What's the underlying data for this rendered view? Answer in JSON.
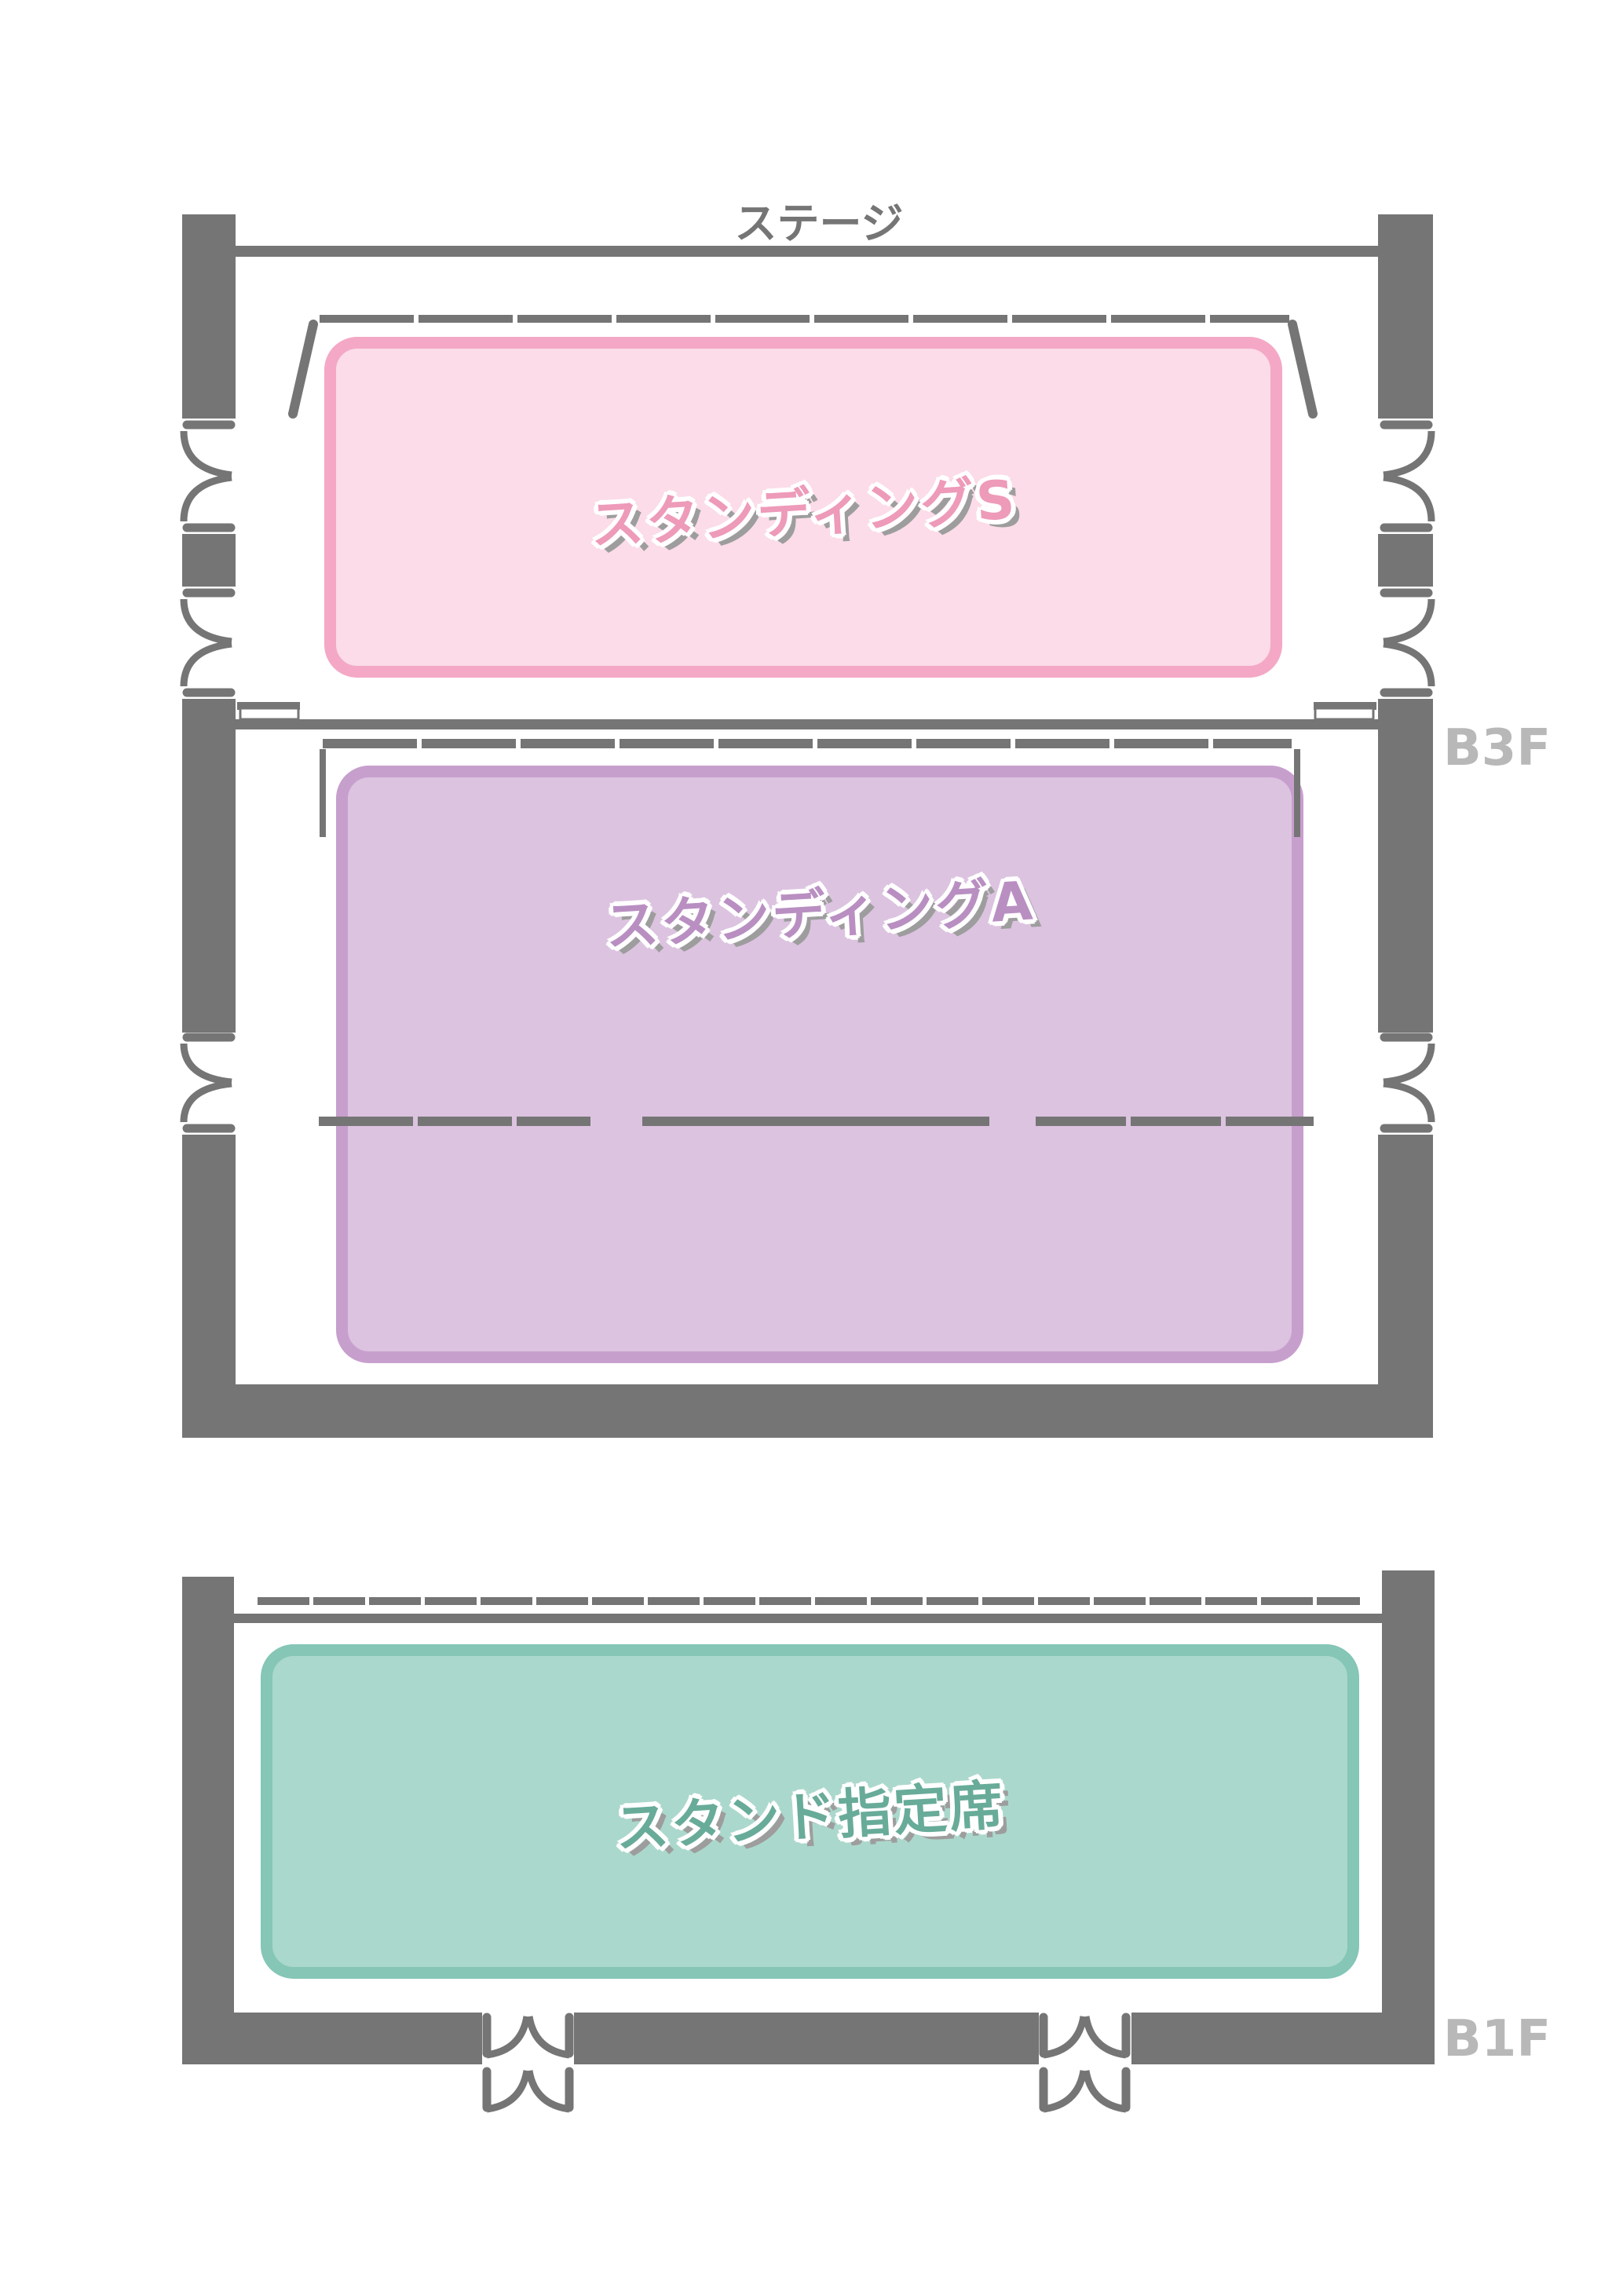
{
  "map": {
    "stage_label": "ステージ",
    "floor_labels": {
      "b3f": "B3F",
      "b1f": "B1F"
    },
    "zones": [
      {
        "id": "standing-s",
        "label": "スタンディングS",
        "fill": "#fbdce8",
        "border": "#f4a8c6",
        "text_color": "#ee9ab9"
      },
      {
        "id": "standing-a",
        "label": "スタンディングA",
        "fill": "#dcc3e0",
        "border": "#c79fcd",
        "text_color": "#b98fc2"
      },
      {
        "id": "stand-reserved",
        "label": "スタンド指定席",
        "fill": "#abd8cc",
        "border": "#85c6b6",
        "text_color": "#68ab99"
      }
    ],
    "colors": {
      "wall": "#757575",
      "stage_text": "#757575",
      "floor_label": "#b8b8b8",
      "label_outline": "#ffffff",
      "label_shadow": "#9d9d9d"
    }
  }
}
